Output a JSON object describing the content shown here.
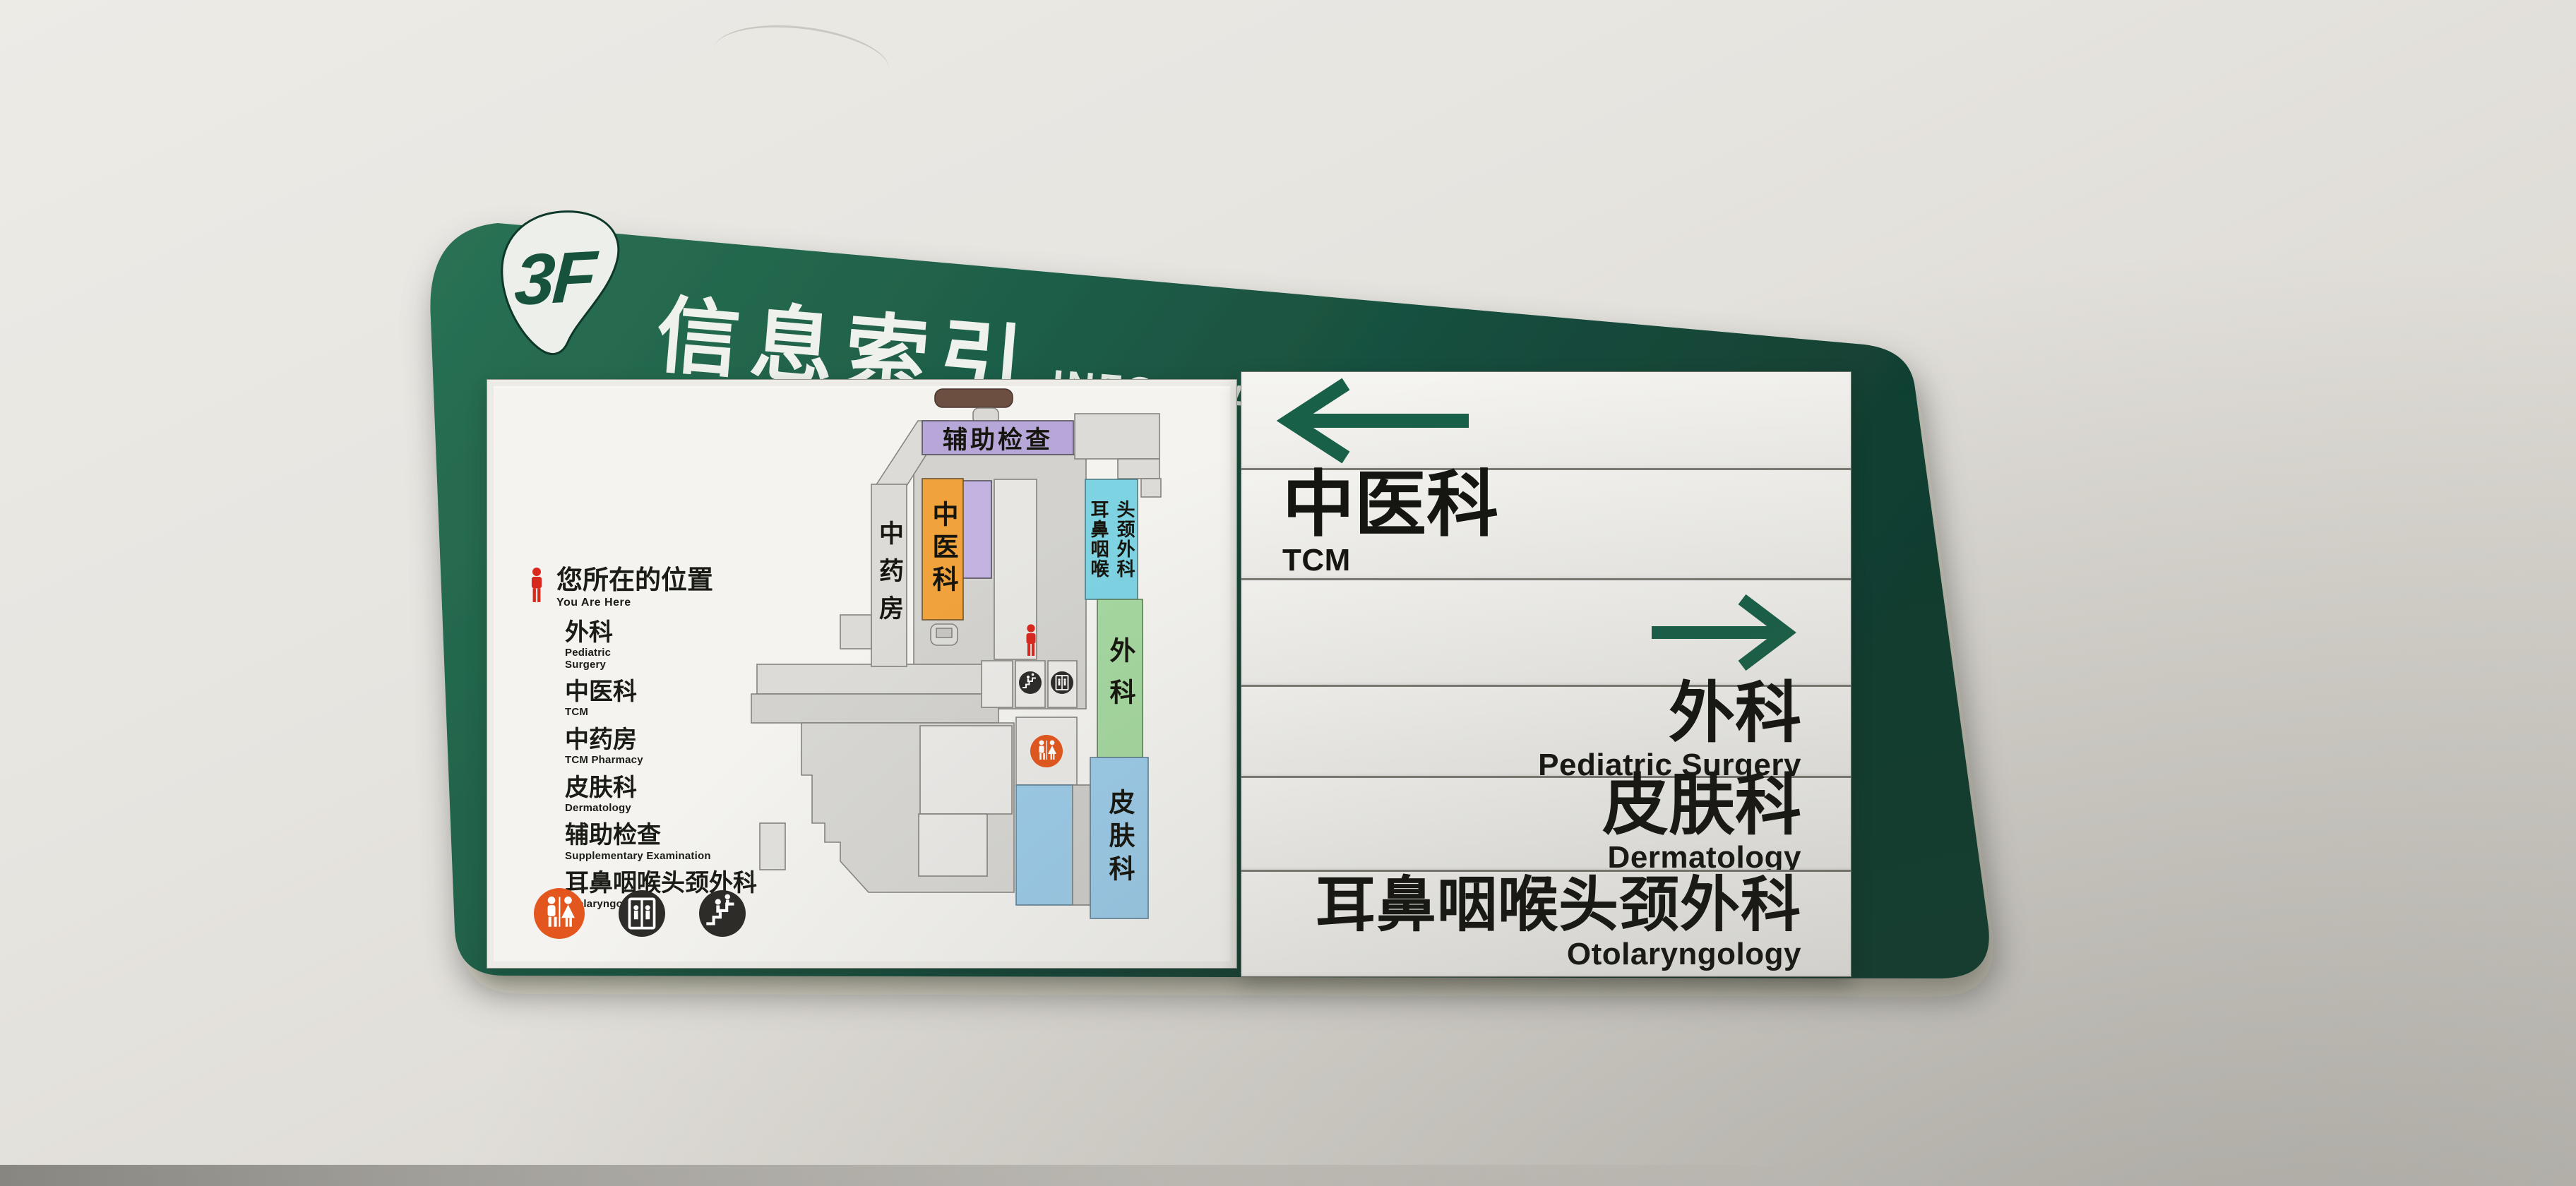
{
  "sign": {
    "floor_badge": "3F",
    "title_cn": "信息索引",
    "title_en": "INFORMATION"
  },
  "map_panel": {
    "you_are_here_cn": "您所在的位置",
    "you_are_here_en": "You Are Here",
    "legend": [
      {
        "cn": "外科",
        "en": "Pediatric\nSurgery"
      },
      {
        "cn": "中医科",
        "en": "TCM"
      },
      {
        "cn": "中药房",
        "en": "TCM Pharmacy"
      },
      {
        "cn": "皮肤科",
        "en": "Dermatology"
      },
      {
        "cn": "辅助检查",
        "en": "Supplementary Examination"
      },
      {
        "cn": "耳鼻咽喉头颈外科",
        "en": "Otolaryngology"
      }
    ],
    "bars": {
      "aux_exam": "辅助检查",
      "tcm_pharmacy": "中药房",
      "tcm": "中医科",
      "ent": "头颈外科\n耳鼻咽喉",
      "surgery": "外科",
      "dermatology": "皮肤科"
    },
    "facility_icons": [
      "restroom",
      "elevator",
      "stairs"
    ]
  },
  "directory": {
    "rows": [
      {
        "type": "arrow",
        "direction": "left"
      },
      {
        "type": "dept",
        "cn": "中医科",
        "en": "TCM"
      },
      {
        "type": "arrow",
        "direction": "right"
      },
      {
        "type": "dept",
        "cn": "外科",
        "en": "Pediatric Surgery"
      },
      {
        "type": "dept",
        "cn": "皮肤科",
        "en": "Dermatology"
      },
      {
        "type": "dept",
        "cn": "耳鼻咽喉头颈外科",
        "en": "Otolaryngology"
      }
    ]
  },
  "colors": {
    "board_green": "#1d5f47",
    "arrow_green": "#186148",
    "badge_text_green": "#17523c",
    "aux_purple": "#b7a7d9",
    "lavender": "#c2b3e0",
    "orange": "#f0a23c",
    "cyan": "#7ed3e3",
    "light_green": "#a6d8a0",
    "light_blue": "#9ccbe8",
    "restroom_orange": "#e3571e",
    "red_marker": "#d8281e"
  }
}
